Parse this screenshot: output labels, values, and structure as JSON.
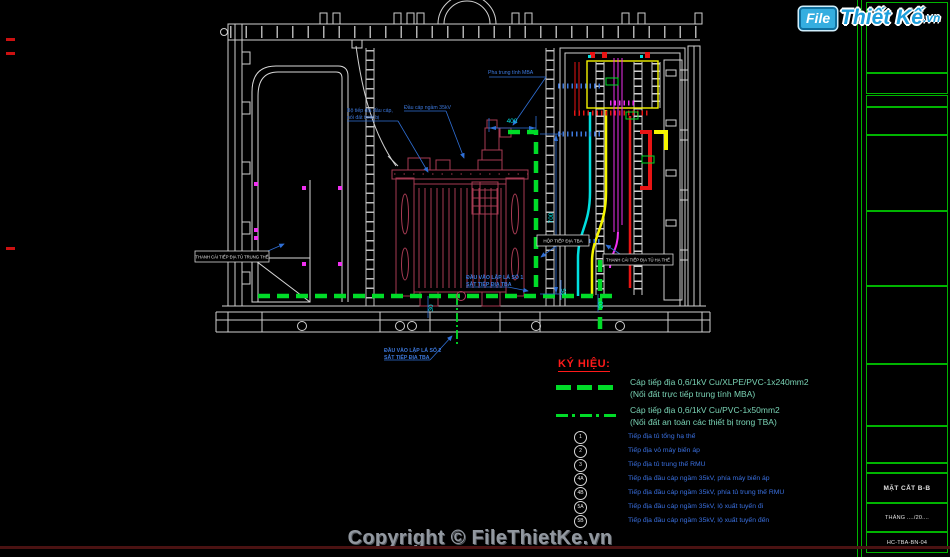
{
  "logo": {
    "file": "File",
    "brand": "Thiết Kế",
    "domain": ".vn"
  },
  "copyright": "Copyright © FileThietKe.vn",
  "legend": {
    "title": "KÝ HIỆU:",
    "cables": [
      {
        "style": "dashed",
        "line1": "Cáp tiếp địa 0,6/1kV Cu/XLPE/PVC-1x240mm2",
        "line2": "(Nối đất trực tiếp trung tính MBA)"
      },
      {
        "style": "dashdot",
        "line1": "Cáp tiếp địa 0,6/1kV Cu/PVC-1x50mm2",
        "line2": "(Nối đất an toàn các thiết bị trong TBA)"
      }
    ],
    "items": [
      {
        "key": "1",
        "label": "Tiếp địa tủ tổng hạ thế"
      },
      {
        "key": "2",
        "label": "Tiếp địa vỏ máy biến áp"
      },
      {
        "key": "3",
        "label": "Tiếp địa tủ trung thế RMU"
      },
      {
        "key": "4A",
        "label": "Tiếp địa đầu cáp ngầm 35kV, phía máy biến áp"
      },
      {
        "key": "4B",
        "label": "Tiếp địa đầu cáp ngầm 35kV, phía tủ trung thế RMU"
      },
      {
        "key": "5A",
        "label": "Tiếp địa đầu cáp ngầm 35kV, lộ xuất tuyến đi"
      },
      {
        "key": "5B",
        "label": "Tiếp địa đầu cáp ngầm 35kV, lộ xuất tuyến đến"
      }
    ]
  },
  "titleblock": {
    "drawing_title": "MẶT CẮT B-B",
    "date": "THÁNG ..../20....",
    "code": "HC-TBA-BN-04"
  },
  "drawing": {
    "callouts": {
      "neutral": "Pha trung tính MBA",
      "cable_head": "Đầu cáp ngầm 35kV",
      "ground_set_1": "Bộ tiếp địa đầu cáp,",
      "ground_set_2": "nối đất thiết bị",
      "inlet1_line1": "ĐẦU VÀO LẬP LÁ SỐ 1",
      "inlet1_line2": "SẮT TIẾP ĐỊA TBA",
      "inlet2_line1": "ĐẦU VÀO LẬP LÁ SỐ 2",
      "inlet2_line2": "SẮT TIẾP ĐỊA TBA",
      "mv_busbar": "THANH CÁI TIẾP ĐỊA TỦ TRUNG THẾ",
      "ground_box": "HỘP TIẾP ĐỊA TBA",
      "lv_busbar": "THANH CÁI TIẾP ĐỊA TỦ HẠ THẾ"
    },
    "dimensions": {
      "d400": "400",
      "d700": "700",
      "d30": "30",
      "d25": "25",
      "d20": "20"
    }
  },
  "colors": {
    "background": "#000000",
    "ground_green": "#00dc28",
    "legend_teal": "#79d2b4",
    "callout_blue": "#3c78dc",
    "dim_cyan": "#00e0e0",
    "transformer_maroon": "#a63a52",
    "titleblock_green": "#00b400",
    "logo_blue": "#1e9fdc",
    "legend_red": "#ff1a1a",
    "copyright_gray": "#9298a0"
  }
}
